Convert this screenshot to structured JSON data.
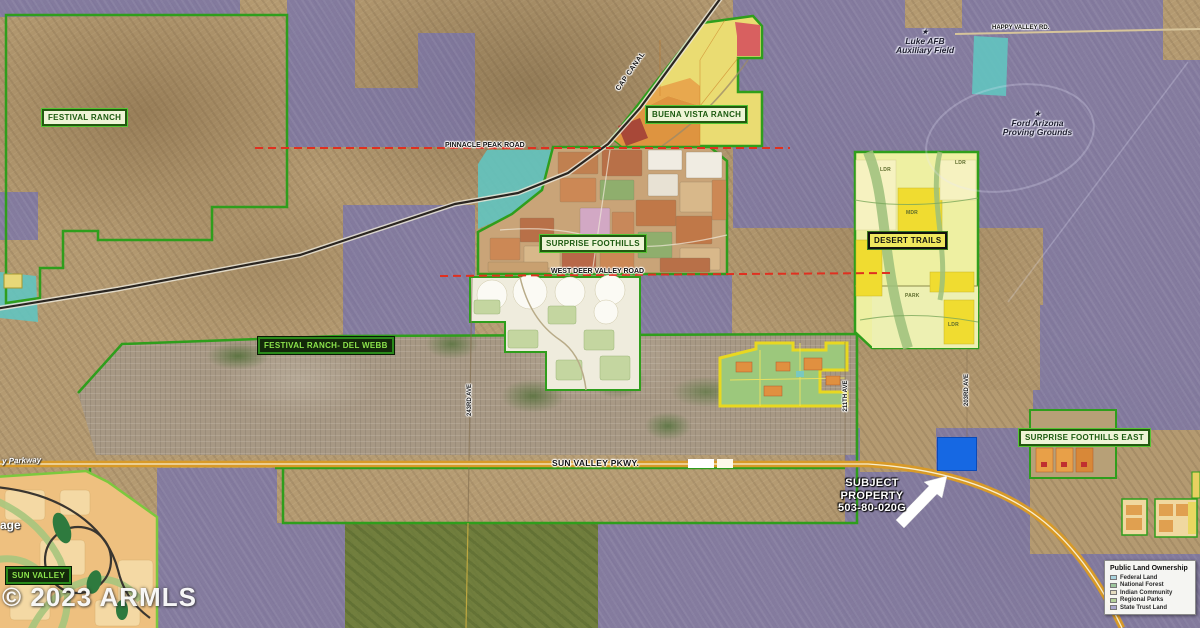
{
  "map": {
    "copyright": "© 2023 ARMLS",
    "parcel_labels": {
      "festival_ranch": "FESTIVAL RANCH",
      "buena_vista_ranch": "BUENA VISTA RANCH",
      "surprise_foothills": "SURPRISE FOOTHILLS",
      "desert_trails": "DESERT TRAILS",
      "festival_ranch_del_webb": "FESTIVAL RANCH- DEL WEBB",
      "surprise_foothills_east": "SURPRISE FOOTHILLS EAST",
      "sun_valley": "SUN VALLEY"
    },
    "road_labels": {
      "pinnacle_peak_road": "PINNACLE PEAK ROAD",
      "west_deer_valley_road": "WEST DEER VALLEY ROAD",
      "happy_valley_road": "HAPPY VALLEY RD.",
      "sun_valley_parkway": "SUN VALLEY PKWY.",
      "cap_canal": "CAP CANAL",
      "avenue_243rd": "243RD AVE",
      "avenue_211th": "211TH AVE",
      "avenue_203rd": "203RD AVE",
      "parkway_fragment": "y Parkway",
      "village_fragment": "age"
    },
    "place_labels": {
      "luke_afb_line1": "Luke AFB",
      "luke_afb_line2": "Auxiliary Field",
      "ford_line1": "Ford Arizona",
      "ford_line2": "Proving Grounds",
      "star": "★"
    },
    "subject_property": {
      "line1": "SUBJECT",
      "line2": "PROPERTY",
      "line3": "503-80-020G"
    },
    "zone_codes": {
      "park": "PARK",
      "ldr": "LDR",
      "mdr": "MDR"
    },
    "legend": {
      "title": "Public Land Ownership",
      "items": [
        {
          "label": "Federal Land",
          "color": "#a9d3de"
        },
        {
          "label": "National Forest",
          "color": "#9cc49c"
        },
        {
          "label": "Indian Community",
          "color": "#e4dcc0"
        },
        {
          "label": "Regional Parks",
          "color": "#b4d19a"
        },
        {
          "label": "State Trust Land",
          "color": "#a8a6cc"
        }
      ]
    },
    "colors": {
      "state_trust_overlay": "#7d7ab0",
      "subject_parcel": "#1668e3",
      "parkway": "#d89a28",
      "boundary_green": "#2f9e1c",
      "section_line_red": "#e03020",
      "canal_teal": "#62c4c0",
      "park_overlay": "#617732"
    }
  }
}
